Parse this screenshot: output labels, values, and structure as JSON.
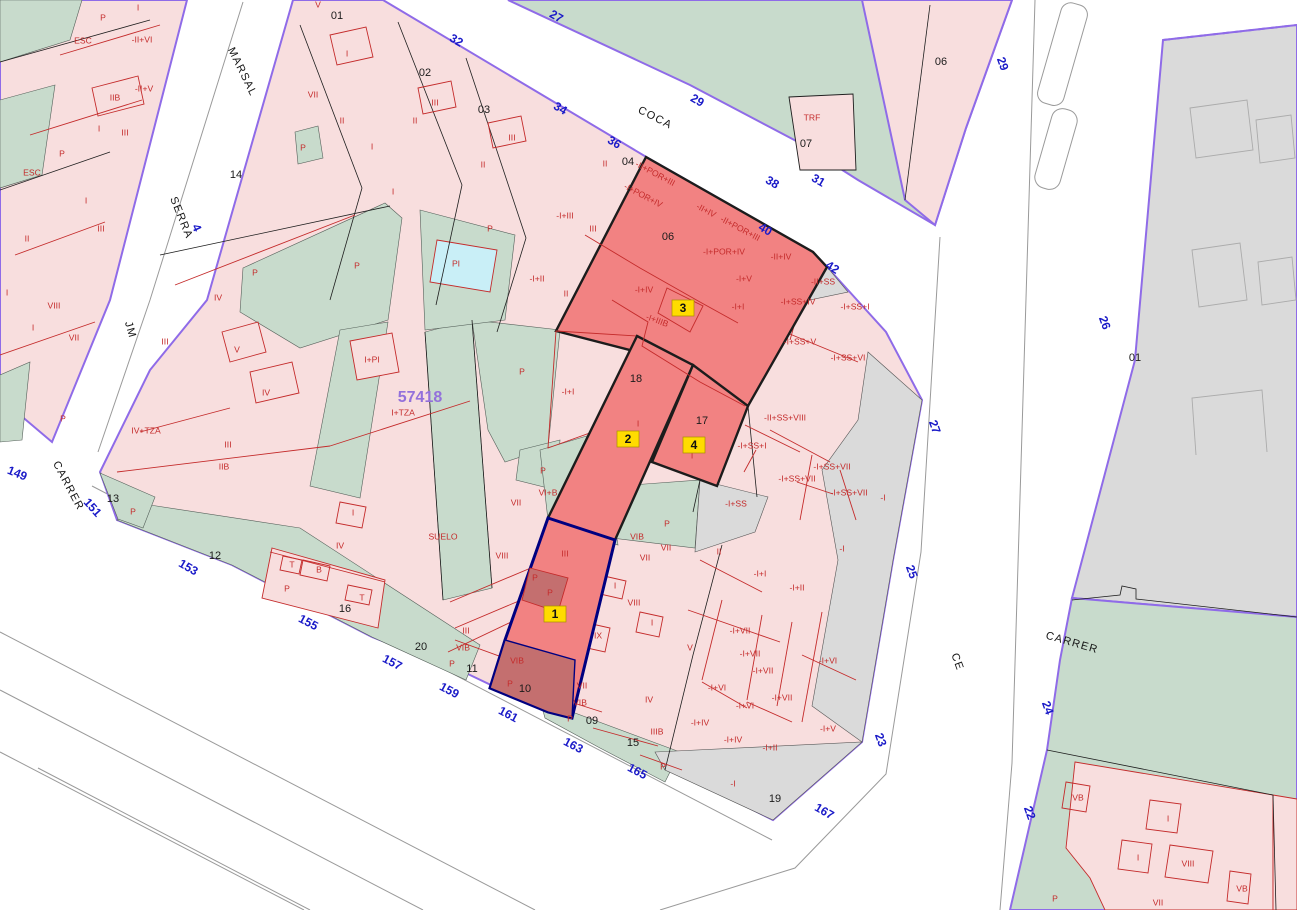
{
  "meta": {
    "title": "Cadastral parcel map",
    "reference_number": "57418"
  },
  "colors": {
    "pink": "#F8DEDE",
    "green": "#C8DBCC",
    "grayarea": "#DADADA",
    "cyan": "#C9EFF7",
    "sel": "#F28282",
    "seldark": "#C46F6F",
    "purple": "#8F6BE8",
    "red": "#C42B2B",
    "blue": "#1A1AC8",
    "yellow": "#FFDC00",
    "ref": "#9370DB"
  },
  "map": {
    "street_names": [
      {
        "t": "MARSAL",
        "x": 242,
        "y": 72,
        "r": 64
      },
      {
        "t": "SERRA",
        "x": 181,
        "y": 218,
        "r": 68
      },
      {
        "t": "JM",
        "x": 130,
        "y": 330,
        "r": 74
      },
      {
        "t": "CARRER",
        "x": 68,
        "y": 486,
        "r": 62
      },
      {
        "t": "COCA",
        "x": 655,
        "y": 118,
        "r": 27
      },
      {
        "t": "CE",
        "x": 957,
        "y": 662,
        "r": 70
      },
      {
        "t": "CARRER",
        "x": 1072,
        "y": 643,
        "r": 16
      }
    ],
    "street_numbers": [
      {
        "t": "32",
        "x": 456,
        "y": 41,
        "r": 30
      },
      {
        "t": "34",
        "x": 560,
        "y": 109,
        "r": 30
      },
      {
        "t": "36",
        "x": 614,
        "y": 143,
        "r": 30
      },
      {
        "t": "38",
        "x": 772,
        "y": 183,
        "r": 30
      },
      {
        "t": "40",
        "x": 765,
        "y": 230,
        "r": 30
      },
      {
        "t": "42",
        "x": 832,
        "y": 268,
        "r": 32
      },
      {
        "t": "27",
        "x": 556,
        "y": 17,
        "r": 30
      },
      {
        "t": "29",
        "x": 697,
        "y": 101,
        "r": 30
      },
      {
        "t": "31",
        "x": 818,
        "y": 181,
        "r": 30
      },
      {
        "t": "149",
        "x": 17,
        "y": 474,
        "r": 22
      },
      {
        "t": "151",
        "x": 92,
        "y": 508,
        "r": 48
      },
      {
        "t": "153",
        "x": 188,
        "y": 568,
        "r": 30
      },
      {
        "t": "155",
        "x": 308,
        "y": 623,
        "r": 28
      },
      {
        "t": "157",
        "x": 392,
        "y": 663,
        "r": 28
      },
      {
        "t": "159",
        "x": 449,
        "y": 691,
        "r": 28
      },
      {
        "t": "161",
        "x": 508,
        "y": 715,
        "r": 28
      },
      {
        "t": "163",
        "x": 573,
        "y": 746,
        "r": 28
      },
      {
        "t": "165",
        "x": 637,
        "y": 772,
        "r": 28
      },
      {
        "t": "167",
        "x": 824,
        "y": 812,
        "r": 30
      },
      {
        "t": "4",
        "x": 196,
        "y": 228,
        "r": 66
      },
      {
        "t": "27",
        "x": 934,
        "y": 427,
        "r": 70
      },
      {
        "t": "25",
        "x": 911,
        "y": 572,
        "r": 70
      },
      {
        "t": "23",
        "x": 880,
        "y": 740,
        "r": 70
      },
      {
        "t": "29",
        "x": 1002,
        "y": 64,
        "r": 70
      },
      {
        "t": "26",
        "x": 1104,
        "y": 323,
        "r": 70
      },
      {
        "t": "24",
        "x": 1047,
        "y": 708,
        "r": 70
      },
      {
        "t": "22",
        "x": 1029,
        "y": 813,
        "r": 70
      }
    ],
    "parcel_numbers": [
      {
        "t": "01",
        "x": 337,
        "y": 16
      },
      {
        "t": "02",
        "x": 425,
        "y": 73
      },
      {
        "t": "03",
        "x": 484,
        "y": 110
      },
      {
        "t": "04",
        "x": 628,
        "y": 162
      },
      {
        "t": "06",
        "x": 668,
        "y": 237
      },
      {
        "t": "07",
        "x": 806,
        "y": 144
      },
      {
        "t": "06",
        "x": 941,
        "y": 62
      },
      {
        "t": "14",
        "x": 236,
        "y": 175
      },
      {
        "t": "13",
        "x": 113,
        "y": 499
      },
      {
        "t": "12",
        "x": 215,
        "y": 556
      },
      {
        "t": "16",
        "x": 345,
        "y": 609
      },
      {
        "t": "20",
        "x": 421,
        "y": 647
      },
      {
        "t": "11",
        "x": 472,
        "y": 669
      },
      {
        "t": "10",
        "x": 525,
        "y": 689
      },
      {
        "t": "09",
        "x": 592,
        "y": 721
      },
      {
        "t": "15",
        "x": 633,
        "y": 743
      },
      {
        "t": "19",
        "x": 775,
        "y": 799
      },
      {
        "t": "18",
        "x": 636,
        "y": 379
      },
      {
        "t": "17",
        "x": 702,
        "y": 421
      },
      {
        "t": "01",
        "x": 1135,
        "y": 358
      }
    ],
    "special_labels": [
      {
        "t": "57418",
        "x": 420,
        "y": 398,
        "c": "ref"
      },
      {
        "t": "I+TZA",
        "x": 403,
        "y": 413,
        "c": "red"
      },
      {
        "t": "SUELO",
        "x": 443,
        "y": 537,
        "c": "red"
      },
      {
        "t": "IV+TZA",
        "x": 146,
        "y": 431,
        "c": "red"
      },
      {
        "t": "TRF",
        "x": 812,
        "y": 118,
        "c": "red"
      },
      {
        "t": "PI",
        "x": 456,
        "y": 264,
        "c": "red"
      }
    ],
    "building_height_labels": [
      {
        "t": "P",
        "x": 103,
        "y": 18
      },
      {
        "t": "I",
        "x": 138,
        "y": 8
      },
      {
        "t": "-II+VI",
        "x": 142,
        "y": 40
      },
      {
        "t": "ESC",
        "x": 83,
        "y": 41
      },
      {
        "t": "-II+V",
        "x": 144,
        "y": 89
      },
      {
        "t": "IIB",
        "x": 115,
        "y": 98
      },
      {
        "t": "I",
        "x": 99,
        "y": 129
      },
      {
        "t": "III",
        "x": 125,
        "y": 133
      },
      {
        "t": "P",
        "x": 62,
        "y": 154
      },
      {
        "t": "ESC",
        "x": 32,
        "y": 173
      },
      {
        "t": "I",
        "x": 86,
        "y": 201
      },
      {
        "t": "III",
        "x": 101,
        "y": 229
      },
      {
        "t": "II",
        "x": 27,
        "y": 239
      },
      {
        "t": "I",
        "x": 7,
        "y": 293
      },
      {
        "t": "VIII",
        "x": 54,
        "y": 306
      },
      {
        "t": "I",
        "x": 33,
        "y": 328
      },
      {
        "t": "VII",
        "x": 74,
        "y": 338
      },
      {
        "t": "P",
        "x": 63,
        "y": 419
      },
      {
        "t": "V",
        "x": 318,
        "y": 5
      },
      {
        "t": "I",
        "x": 347,
        "y": 54
      },
      {
        "t": "VII",
        "x": 313,
        "y": 95
      },
      {
        "t": "II",
        "x": 342,
        "y": 121
      },
      {
        "t": "I",
        "x": 372,
        "y": 147
      },
      {
        "t": "III",
        "x": 435,
        "y": 103
      },
      {
        "t": "II",
        "x": 415,
        "y": 121
      },
      {
        "t": "III",
        "x": 512,
        "y": 138
      },
      {
        "t": "II",
        "x": 483,
        "y": 165
      },
      {
        "t": "I",
        "x": 393,
        "y": 192
      },
      {
        "t": "P",
        "x": 303,
        "y": 148
      },
      {
        "t": "II",
        "x": 605,
        "y": 164
      },
      {
        "t": "P",
        "x": 255,
        "y": 273
      },
      {
        "t": "P",
        "x": 357,
        "y": 266
      },
      {
        "t": "IV",
        "x": 218,
        "y": 298
      },
      {
        "t": "III",
        "x": 165,
        "y": 342
      },
      {
        "t": "V",
        "x": 237,
        "y": 350
      },
      {
        "t": "IV",
        "x": 266,
        "y": 393
      },
      {
        "t": "III",
        "x": 228,
        "y": 445
      },
      {
        "t": "IIB",
        "x": 224,
        "y": 467
      },
      {
        "t": "I+PI",
        "x": 372,
        "y": 360
      },
      {
        "t": "I",
        "x": 353,
        "y": 513
      },
      {
        "t": "IV",
        "x": 340,
        "y": 546
      },
      {
        "t": "T",
        "x": 292,
        "y": 565
      },
      {
        "t": "B",
        "x": 319,
        "y": 570
      },
      {
        "t": "T",
        "x": 362,
        "y": 598
      },
      {
        "t": "P",
        "x": 287,
        "y": 589
      },
      {
        "t": "P",
        "x": 133,
        "y": 512
      },
      {
        "t": "P",
        "x": 490,
        "y": 229
      },
      {
        "t": "-I+III",
        "x": 565,
        "y": 216
      },
      {
        "t": "III",
        "x": 593,
        "y": 229
      },
      {
        "t": "-I+II",
        "x": 537,
        "y": 279
      },
      {
        "t": "II",
        "x": 566,
        "y": 294
      },
      {
        "t": "P",
        "x": 522,
        "y": 372
      },
      {
        "t": "P",
        "x": 543,
        "y": 471
      },
      {
        "t": "VI+B",
        "x": 548,
        "y": 493
      },
      {
        "t": "VII",
        "x": 516,
        "y": 503
      },
      {
        "t": "VIII",
        "x": 502,
        "y": 556
      },
      {
        "t": "III",
        "x": 466,
        "y": 631
      },
      {
        "t": "VIB",
        "x": 463,
        "y": 648
      },
      {
        "t": "P",
        "x": 452,
        "y": 664
      },
      {
        "t": "-I+I",
        "x": 568,
        "y": 392
      },
      {
        "t": "I",
        "x": 638,
        "y": 424
      },
      {
        "t": "I",
        "x": 692,
        "y": 456
      },
      {
        "t": "III",
        "x": 565,
        "y": 554
      },
      {
        "t": "P",
        "x": 535,
        "y": 578
      },
      {
        "t": "P",
        "x": 550,
        "y": 593
      },
      {
        "t": "VIB",
        "x": 637,
        "y": 537
      },
      {
        "t": "VII",
        "x": 666,
        "y": 548
      },
      {
        "t": "VII",
        "x": 645,
        "y": 558
      },
      {
        "t": "I",
        "x": 615,
        "y": 586
      },
      {
        "t": "VIII",
        "x": 634,
        "y": 603
      },
      {
        "t": "IX",
        "x": 598,
        "y": 636
      },
      {
        "t": "I",
        "x": 652,
        "y": 623
      },
      {
        "t": "V",
        "x": 690,
        "y": 648
      },
      {
        "t": "P",
        "x": 667,
        "y": 524
      },
      {
        "t": "VIB",
        "x": 517,
        "y": 661
      },
      {
        "t": "P",
        "x": 510,
        "y": 684
      },
      {
        "t": "VII",
        "x": 582,
        "y": 686
      },
      {
        "t": "VIB",
        "x": 580,
        "y": 703
      },
      {
        "t": "P",
        "x": 570,
        "y": 719
      },
      {
        "t": "IV",
        "x": 649,
        "y": 700
      },
      {
        "t": "IIIB",
        "x": 657,
        "y": 732
      },
      {
        "t": "P",
        "x": 663,
        "y": 767
      },
      {
        "t": "-II+POR+III",
        "x": 655,
        "y": 174,
        "r": 28
      },
      {
        "t": "-I+POR+IV",
        "x": 643,
        "y": 196,
        "r": 28
      },
      {
        "t": "-II+IV",
        "x": 706,
        "y": 211,
        "r": 28
      },
      {
        "t": "-II+POR+III",
        "x": 740,
        "y": 229,
        "r": 28
      },
      {
        "t": "-I+POR+IV",
        "x": 724,
        "y": 252
      },
      {
        "t": "-II+IV",
        "x": 781,
        "y": 257
      },
      {
        "t": "-I+V",
        "x": 744,
        "y": 279
      },
      {
        "t": "-I+I",
        "x": 738,
        "y": 307
      },
      {
        "t": "-I+IV",
        "x": 644,
        "y": 290
      },
      {
        "t": "-I+IIIB",
        "x": 657,
        "y": 321,
        "r": 20
      },
      {
        "t": "-II+SS",
        "x": 823,
        "y": 282
      },
      {
        "t": "-I+SS+IV",
        "x": 798,
        "y": 302
      },
      {
        "t": "-I+SS+I",
        "x": 855,
        "y": 307
      },
      {
        "t": "-I+SS+V",
        "x": 800,
        "y": 342
      },
      {
        "t": "-I+SS+VI",
        "x": 848,
        "y": 358
      },
      {
        "t": "-II+SS+VIII",
        "x": 785,
        "y": 418
      },
      {
        "t": "-I+SS+I",
        "x": 752,
        "y": 446
      },
      {
        "t": "-I+SS+VII",
        "x": 832,
        "y": 467
      },
      {
        "t": "-I+SS+VII",
        "x": 797,
        "y": 479
      },
      {
        "t": "-I+SS+VII",
        "x": 849,
        "y": 493
      },
      {
        "t": "-I",
        "x": 883,
        "y": 498
      },
      {
        "t": "-I+SS",
        "x": 736,
        "y": 504
      },
      {
        "t": "II",
        "x": 719,
        "y": 552
      },
      {
        "t": "-I+I",
        "x": 760,
        "y": 574
      },
      {
        "t": "-I+II",
        "x": 797,
        "y": 588
      },
      {
        "t": "-I",
        "x": 842,
        "y": 549
      },
      {
        "t": "-I+VII",
        "x": 740,
        "y": 631
      },
      {
        "t": "-I+VII",
        "x": 750,
        "y": 654
      },
      {
        "t": "-I+VII",
        "x": 763,
        "y": 671
      },
      {
        "t": "-I+VI",
        "x": 717,
        "y": 688
      },
      {
        "t": "-I+VI",
        "x": 745,
        "y": 706
      },
      {
        "t": "-I+VII",
        "x": 782,
        "y": 698
      },
      {
        "t": "-I+VI",
        "x": 828,
        "y": 661
      },
      {
        "t": "-I+V",
        "x": 828,
        "y": 729
      },
      {
        "t": "-I+IV",
        "x": 700,
        "y": 723
      },
      {
        "t": "-I+IV",
        "x": 733,
        "y": 740
      },
      {
        "t": "-I+II",
        "x": 770,
        "y": 748
      },
      {
        "t": "-I",
        "x": 733,
        "y": 784
      },
      {
        "t": "VB",
        "x": 1078,
        "y": 798
      },
      {
        "t": "I",
        "x": 1168,
        "y": 819
      },
      {
        "t": "I",
        "x": 1138,
        "y": 858
      },
      {
        "t": "VIII",
        "x": 1188,
        "y": 864
      },
      {
        "t": "VII",
        "x": 1158,
        "y": 903
      },
      {
        "t": "VB",
        "x": 1242,
        "y": 889
      },
      {
        "t": "P",
        "x": 1055,
        "y": 899
      }
    ],
    "selection_badges": [
      {
        "t": "1",
        "x": 555,
        "y": 614
      },
      {
        "t": "2",
        "x": 628,
        "y": 439
      },
      {
        "t": "3",
        "x": 683,
        "y": 308
      },
      {
        "t": "4",
        "x": 694,
        "y": 445
      }
    ]
  }
}
